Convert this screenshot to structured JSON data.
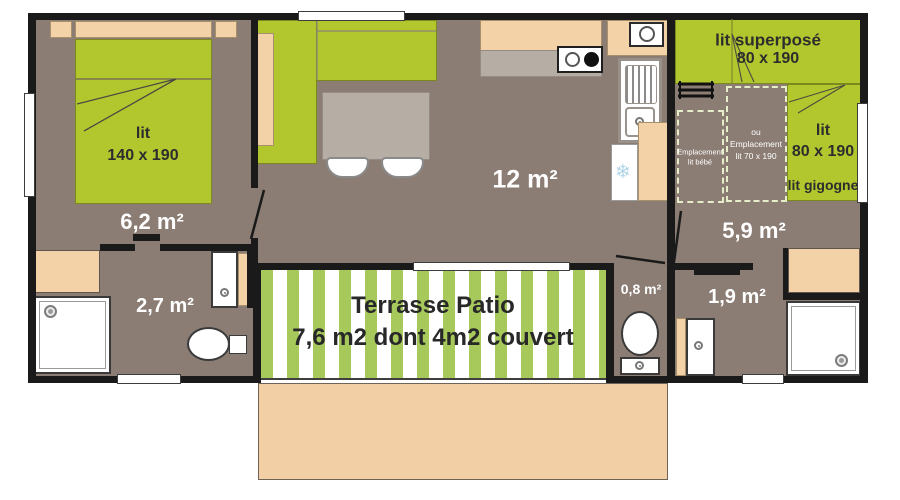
{
  "plan_type": "mobile-home floor plan",
  "colors": {
    "wall": "#1a1a1a",
    "floor": "#8b7d74",
    "furniture_green": "#b2c72e",
    "terrace_stripe_green": "#a7c95c",
    "wood_peach": "#f4d2a8",
    "counter_gray": "#b6ada5",
    "white": "#ffffff",
    "snowflake_blue": "#aed4e8",
    "label_white": "#ffffff",
    "label_dark": "#2d2d2d"
  },
  "rooms": {
    "bedroom_left": {
      "area": "6,2 m²",
      "bed_label": "lit",
      "bed_size": "140 x 190"
    },
    "bathroom_left": {
      "area": "2,7 m²"
    },
    "living": {
      "area": "12 m²"
    },
    "bedroom_right": {
      "area": "5,9 m²",
      "bunk_label": "lit superposé",
      "bunk_size": "80 x 190",
      "single_label": "lit",
      "single_size": "80 x 190",
      "trundle_note": "lit gigogne",
      "baby_spot_line1": "Emplacement",
      "baby_spot_line2": "lit bébé",
      "alt_spot_line1": "ou",
      "alt_spot_line2": "Emplacement",
      "alt_spot_line3": "lit 70 x 190"
    },
    "wc": {
      "area": "0,8 m²"
    },
    "bathroom_right": {
      "area": "1,9 m²"
    }
  },
  "terrace": {
    "title": "Terrasse Patio",
    "subtitle": "7,6 m2 dont 4m2 couvert"
  },
  "icons": [
    "snowflake-icon",
    "ladder-icon",
    "shower-drain-icon",
    "stove-burner-icon",
    "sink-icon",
    "toilet-icon",
    "washbasin-icon",
    "door-swing-icon",
    "window-icon"
  ]
}
